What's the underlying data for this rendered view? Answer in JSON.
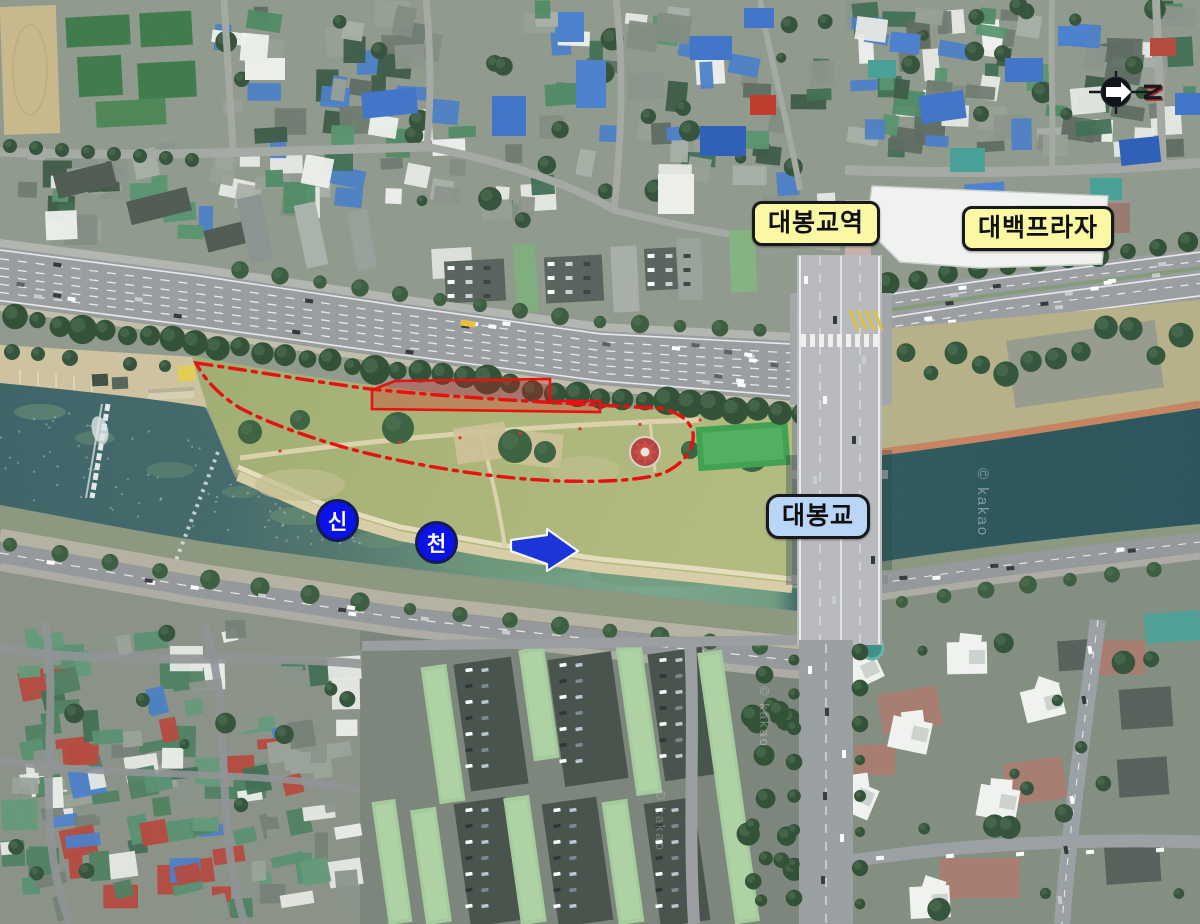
{
  "map": {
    "labels": {
      "station": "대봉교역",
      "plaza": "대백프라자",
      "bridge": "대봉교"
    },
    "river_badges": [
      {
        "char": "신"
      },
      {
        "char": "천"
      }
    ],
    "compass": {
      "letter": "N"
    },
    "watermark": "© kakao",
    "colors": {
      "annotation_red": "#e81010",
      "arrow_blue": "#1b35d8",
      "badge_blue": "#0a12e8",
      "label_yellow": "#fbf8a4",
      "label_blue": "#b9d6f6",
      "water_dark": "#2e5a5e",
      "water_murky": "#74a189",
      "park_green": "#a9b475"
    }
  }
}
